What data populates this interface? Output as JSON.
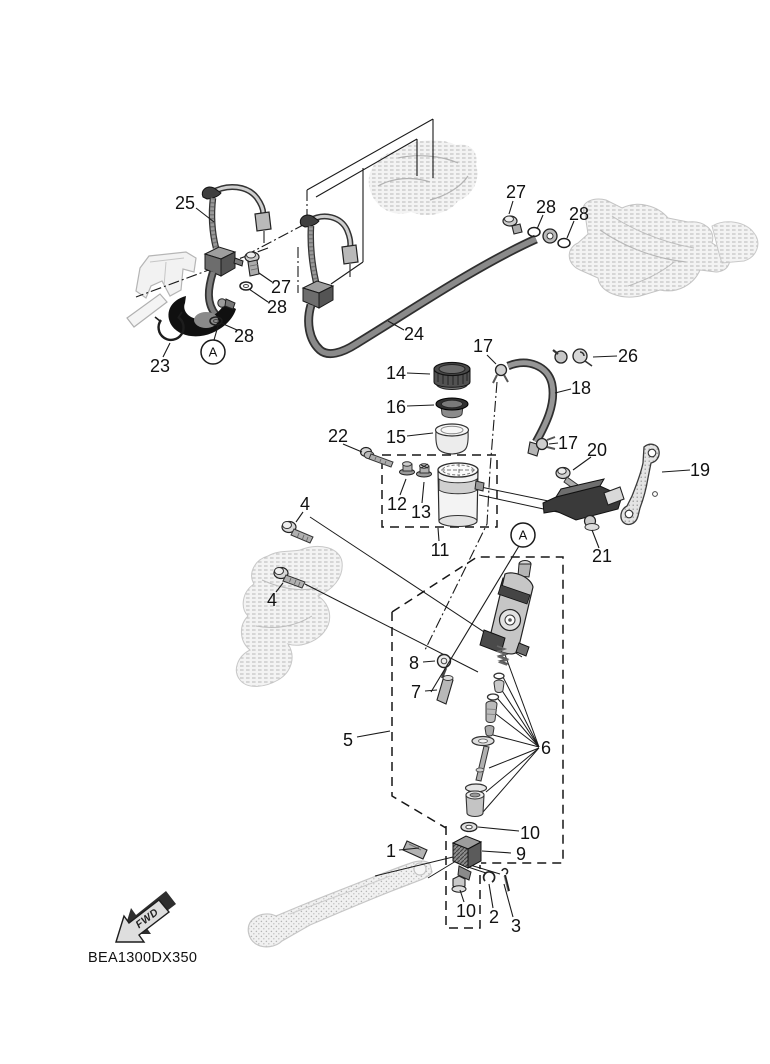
{
  "diagram": {
    "code": "BEA1300DX350",
    "fwd_label": "FWD",
    "colors": {
      "line": "#1a1a1a",
      "reference": "#c9c9c9",
      "dark_fill": "#3c3c3c",
      "light_fill": "#ececec"
    }
  },
  "callouts": [
    {
      "t": "1",
      "x": 391,
      "y": 851,
      "leader": [
        [
          399,
          850
        ],
        [
          419,
          848
        ]
      ]
    },
    {
      "t": "2",
      "x": 494,
      "y": 917,
      "leader": [
        [
          493,
          908
        ],
        [
          489,
          884
        ]
      ]
    },
    {
      "t": "3",
      "x": 516,
      "y": 926,
      "leader": [
        [
          513,
          917
        ],
        [
          504,
          884
        ]
      ]
    },
    {
      "t": "4",
      "x": 305,
      "y": 504,
      "leader": [
        [
          303,
          512
        ],
        [
          296,
          522
        ]
      ]
    },
    {
      "t": "4",
      "x": 272,
      "y": 600,
      "leader": [
        [
          276,
          592
        ],
        [
          283,
          583
        ]
      ]
    },
    {
      "t": "5",
      "x": 348,
      "y": 740,
      "leader": [
        [
          357,
          737
        ],
        [
          390,
          731
        ]
      ]
    },
    {
      "t": "6",
      "x": 546,
      "y": 748,
      "leader": []
    },
    {
      "t": "7",
      "x": 416,
      "y": 692,
      "leader": [
        [
          425,
          691
        ],
        [
          437,
          690
        ]
      ]
    },
    {
      "t": "8",
      "x": 414,
      "y": 663,
      "leader": [
        [
          423,
          662
        ],
        [
          435,
          661
        ]
      ]
    },
    {
      "t": "9",
      "x": 521,
      "y": 854,
      "leader": [
        [
          511,
          853
        ],
        [
          482,
          851
        ]
      ]
    },
    {
      "t": "10",
      "x": 530,
      "y": 833,
      "leader": [
        [
          519,
          831
        ],
        [
          478,
          827
        ]
      ]
    },
    {
      "t": "10",
      "x": 466,
      "y": 911,
      "leader": [
        [
          464,
          902
        ],
        [
          460,
          890
        ]
      ]
    },
    {
      "t": "11",
      "x": 440,
      "y": 550,
      "leader": [
        [
          439,
          541
        ],
        [
          438,
          528
        ]
      ]
    },
    {
      "t": "12",
      "x": 397,
      "y": 504,
      "leader": [
        [
          400,
          495
        ],
        [
          406,
          479
        ]
      ]
    },
    {
      "t": "13",
      "x": 421,
      "y": 512,
      "leader": [
        [
          422,
          503
        ],
        [
          424,
          482
        ]
      ]
    },
    {
      "t": "14",
      "x": 396,
      "y": 373,
      "leader": [
        [
          407,
          373
        ],
        [
          430,
          374
        ]
      ]
    },
    {
      "t": "15",
      "x": 396,
      "y": 437,
      "leader": [
        [
          407,
          436
        ],
        [
          433,
          433
        ]
      ]
    },
    {
      "t": "16",
      "x": 396,
      "y": 407,
      "leader": [
        [
          407,
          406
        ],
        [
          434,
          405
        ]
      ]
    },
    {
      "t": "17",
      "x": 483,
      "y": 346,
      "leader": [
        [
          487,
          355
        ],
        [
          496,
          364
        ]
      ]
    },
    {
      "t": "17",
      "x": 568,
      "y": 443,
      "leader": [
        [
          558,
          443
        ],
        [
          549,
          444
        ]
      ]
    },
    {
      "t": "18",
      "x": 581,
      "y": 388,
      "leader": [
        [
          571,
          389
        ],
        [
          555,
          393
        ]
      ]
    },
    {
      "t": "19",
      "x": 700,
      "y": 470,
      "leader": [
        [
          690,
          470
        ],
        [
          662,
          472
        ]
      ]
    },
    {
      "t": "20",
      "x": 597,
      "y": 450,
      "leader": [
        [
          591,
          457
        ],
        [
          573,
          470
        ]
      ]
    },
    {
      "t": "21",
      "x": 602,
      "y": 556,
      "leader": [
        [
          599,
          548
        ],
        [
          592,
          530
        ]
      ]
    },
    {
      "t": "22",
      "x": 338,
      "y": 436,
      "leader": [
        [
          343,
          444
        ],
        [
          362,
          452
        ]
      ]
    },
    {
      "t": "23",
      "x": 160,
      "y": 366,
      "leader": [
        [
          163,
          357
        ],
        [
          170,
          343
        ]
      ]
    },
    {
      "t": "24",
      "x": 414,
      "y": 334,
      "leader": [
        [
          404,
          330
        ],
        [
          388,
          321
        ]
      ]
    },
    {
      "t": "25",
      "x": 185,
      "y": 203,
      "leader": [
        [
          196,
          208
        ],
        [
          214,
          222
        ]
      ]
    },
    {
      "t": "26",
      "x": 628,
      "y": 356,
      "leader": [
        [
          617,
          356
        ],
        [
          593,
          357
        ]
      ]
    },
    {
      "t": "27",
      "x": 281,
      "y": 287,
      "leader": [
        [
          272,
          282
        ],
        [
          259,
          273
        ]
      ]
    },
    {
      "t": "27",
      "x": 516,
      "y": 192,
      "leader": [
        [
          513,
          201
        ],
        [
          509,
          214
        ]
      ]
    },
    {
      "t": "28",
      "x": 277,
      "y": 307,
      "leader": [
        [
          268,
          302
        ],
        [
          249,
          289
        ]
      ]
    },
    {
      "t": "28",
      "x": 244,
      "y": 336,
      "leader": [
        [
          237,
          330
        ],
        [
          221,
          323
        ]
      ]
    },
    {
      "t": "28",
      "x": 546,
      "y": 207,
      "leader": [
        [
          543,
          215
        ],
        [
          537,
          229
        ]
      ]
    },
    {
      "t": "28",
      "x": 579,
      "y": 214,
      "leader": [
        [
          574,
          221
        ],
        [
          567,
          238
        ]
      ]
    }
  ],
  "markers": [
    {
      "t": "A",
      "x": 213,
      "y": 352,
      "r": 12,
      "leader": [
        [
          214,
          340
        ],
        [
          218,
          326
        ]
      ]
    },
    {
      "t": "A",
      "x": 523,
      "y": 535,
      "r": 12,
      "leader": [
        [
          519,
          546
        ],
        [
          431,
          692
        ]
      ]
    }
  ],
  "relation_lines": [
    [
      [
        310,
        517
      ],
      [
        522,
        657
      ]
    ],
    [
      [
        305,
        584
      ],
      [
        478,
        672
      ]
    ],
    [
      [
        558,
        503
      ],
      [
        476,
        486
      ]
    ],
    [
      [
        562,
        513
      ],
      [
        479,
        495
      ]
    ],
    [
      [
        453,
        857
      ],
      [
        375,
        876
      ]
    ],
    [
      [
        456,
        861
      ],
      [
        428,
        878
      ]
    ],
    [
      [
        468,
        867
      ],
      [
        486,
        873
      ]
    ],
    [
      [
        470,
        865
      ],
      [
        500,
        874
      ]
    ],
    [
      [
        504,
        652
      ],
      [
        539,
        747
      ]
    ],
    [
      [
        503,
        677
      ],
      [
        539,
        747
      ]
    ],
    [
      [
        501,
        689
      ],
      [
        539,
        747
      ]
    ],
    [
      [
        498,
        699
      ],
      [
        539,
        747
      ]
    ],
    [
      [
        496,
        714
      ],
      [
        539,
        747
      ]
    ],
    [
      [
        493,
        735
      ],
      [
        539,
        747
      ]
    ],
    [
      [
        489,
        768
      ],
      [
        539,
        748
      ]
    ],
    [
      [
        486,
        792
      ],
      [
        539,
        748
      ]
    ],
    [
      [
        483,
        812
      ],
      [
        538,
        749
      ]
    ]
  ],
  "chain_lines": [
    [
      [
        307,
        190
      ],
      [
        307,
        223
      ]
    ],
    [
      [
        305,
        224
      ],
      [
        252,
        252
      ]
    ],
    [
      [
        298,
        247
      ],
      [
        298,
        293
      ]
    ],
    [
      [
        268,
        248
      ],
      [
        136,
        297
      ]
    ],
    [
      [
        497,
        382
      ],
      [
        490,
        470
      ],
      [
        487,
        524
      ],
      [
        425,
        650
      ]
    ]
  ]
}
